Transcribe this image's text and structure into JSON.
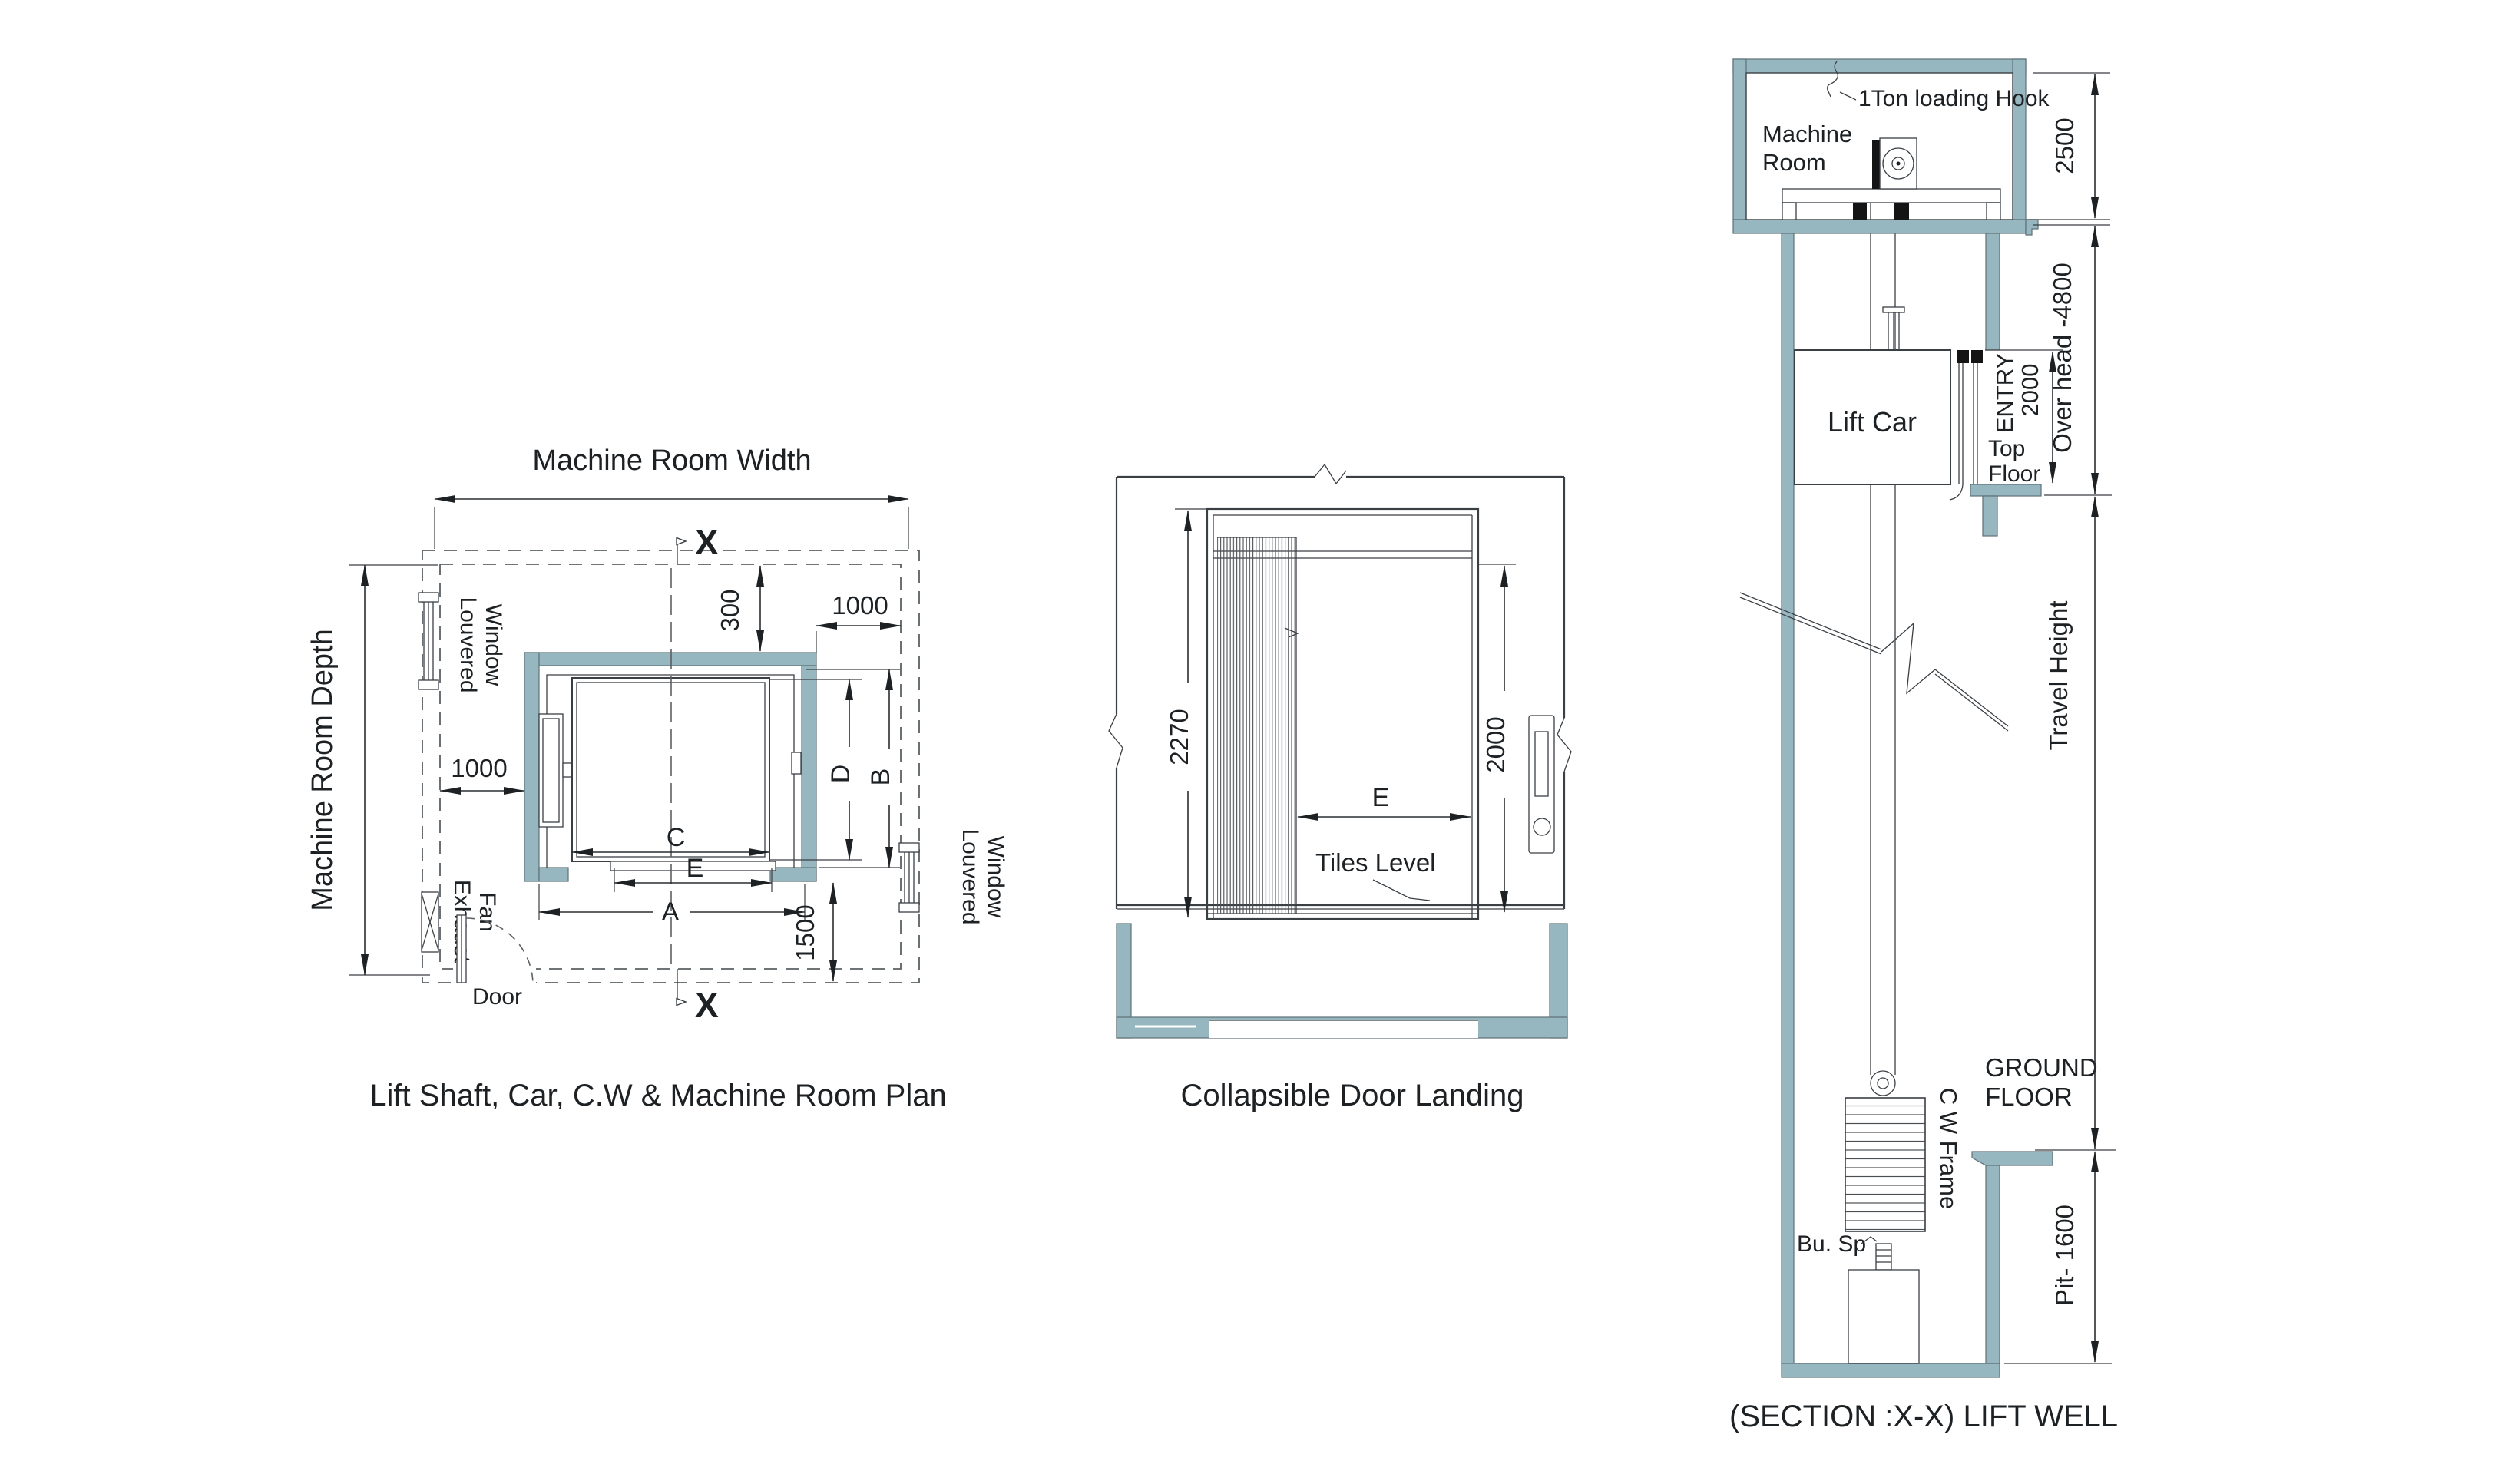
{
  "colors": {
    "wall_teal": "#96b7c0",
    "line": "#3a3f44",
    "text": "#1d2124",
    "background": "#ffffff"
  },
  "plan": {
    "title": "Lift Shaft, Car, C.W & Machine Room Plan",
    "width_label": "Machine Room Width",
    "depth_label": "Machine Room Depth",
    "dim_300": "300",
    "dim_1000_top": "1000",
    "dim_1000_left": "1000",
    "dim_1500": "1500",
    "letter_a": "A",
    "letter_b": "B",
    "letter_c": "C",
    "letter_d": "D",
    "letter_e": "E",
    "louvered_line1": "Louvered",
    "louvered_line2": "Window",
    "exhaust_line1": "Exhaust",
    "exhaust_line2": "Fan",
    "door": "Door",
    "section_marker": "X"
  },
  "landing": {
    "title": "Collapsible Door Landing",
    "dim_2270": "2270",
    "dim_2000": "2000",
    "letter_e": "E",
    "tiles_level": "Tiles Level"
  },
  "section": {
    "title": "(SECTION :X-X) LIFT WELL",
    "hook_label": "1Ton loading Hook",
    "machine_room_line1": "Machine",
    "machine_room_line2": "Room",
    "dim_2500": "2500",
    "overhead_label": "Over head -4800",
    "lift_car": "Lift Car",
    "entry_label": "ENTRY",
    "entry_dim": "2000",
    "top_floor_line1": "Top",
    "top_floor_line2": "Floor",
    "travel_height": "Travel Height",
    "ground_floor_line1": "GROUND",
    "ground_floor_line2": "FLOOR",
    "cw_frame": "C W Frame",
    "buffer_label": "Bu. Sp",
    "pit_dim": "Pit- 1600"
  }
}
